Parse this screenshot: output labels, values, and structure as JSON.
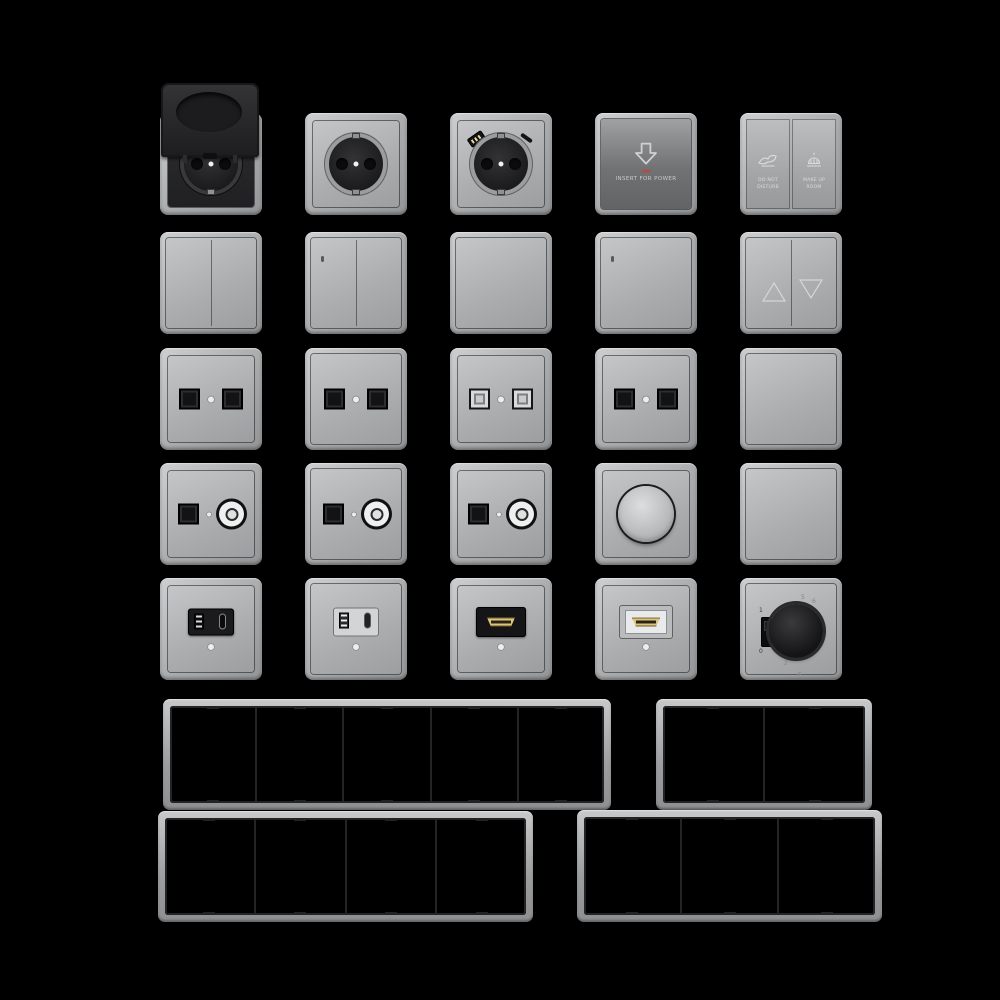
{
  "page": {
    "background_color": "#000000",
    "description": "Catalog render of modular wall switches, sockets and mounting frames on black"
  },
  "colors": {
    "frame_gray": "#b5b7b9",
    "plate_gray": "#adafb1",
    "card_switch_gray": "#6e7072",
    "module_black": "#1b1b1d",
    "port_black": "#131315",
    "indicator_white": "#eceded",
    "hdmi_gold": "#dcc47c",
    "led_red": "#a5524a",
    "label_light": "#d6d8da"
  },
  "grid": {
    "rows": [
      [
        "socket-with-hinged-cover",
        "schuko-socket",
        "schuko-socket-usb",
        "key-card-switch",
        "hotel-service-switch"
      ],
      [
        "switch-2gang",
        "switch-2gang-indicator",
        "switch-1gang",
        "switch-1gang-indicator",
        "shutter-switch"
      ],
      [
        "data-socket-2port",
        "data-socket-2port",
        "data-socket-2port-light",
        "data-socket-2port",
        "switch-1gang-flat"
      ],
      [
        "tv-data-socket",
        "tv-data-socket",
        "tv-data-socket",
        "rotary-dimmer",
        "blank-plate"
      ],
      [
        "usb-charger-black",
        "usb-charger-light",
        "hdmi-socket-black",
        "hdmi-socket-light",
        "thermostat"
      ]
    ]
  },
  "items": {
    "card_switch": {
      "label": "INSERT FOR POWER"
    },
    "hotel_switch": {
      "left": {
        "lines": [
          "DO NOT",
          "DISTURB"
        ]
      },
      "right": {
        "lines": [
          "MAKE UP",
          "ROOM"
        ]
      }
    },
    "thermostat": {
      "slider": {
        "on": "1",
        "off": "0"
      },
      "dial": [
        "5",
        "6",
        "4",
        "3",
        "2"
      ],
      "frost": "❄"
    }
  },
  "frames": [
    {
      "name": "frame-5gang",
      "slots": 5
    },
    {
      "name": "frame-2gang",
      "slots": 2
    },
    {
      "name": "frame-4gang",
      "slots": 4
    },
    {
      "name": "frame-3gang",
      "slots": 3
    }
  ]
}
